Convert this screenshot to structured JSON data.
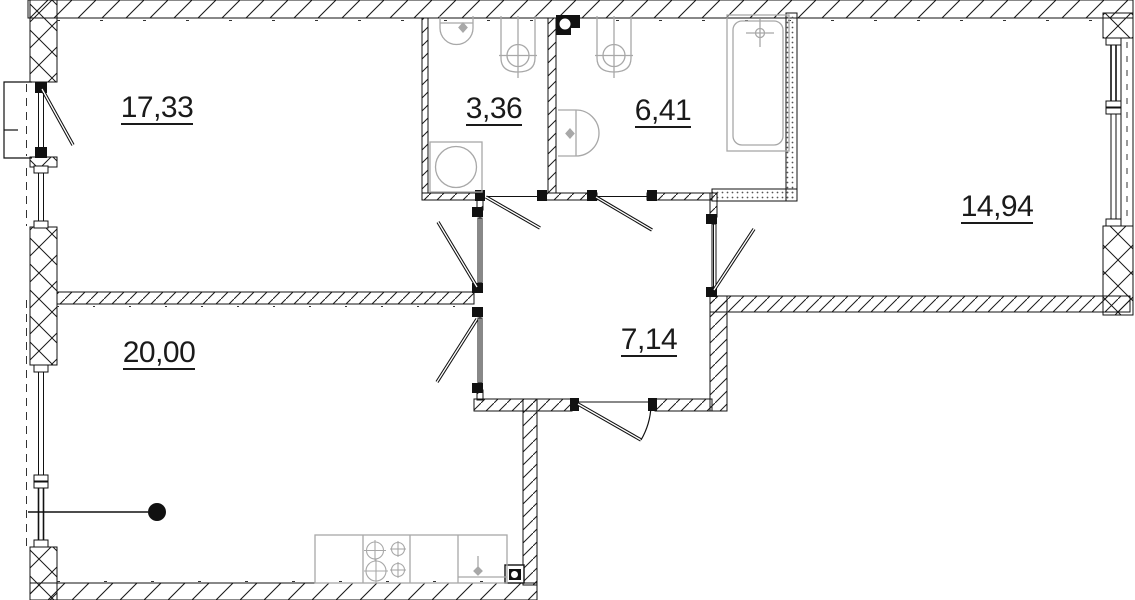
{
  "plan": {
    "background": "#ffffff",
    "line_color": "#1a1a1a",
    "fixture_color": "#a8a8a8",
    "rooms": [
      {
        "id": "room-17-33",
        "area": "17,33"
      },
      {
        "id": "bathroom-small",
        "area": "3,36"
      },
      {
        "id": "bathroom-large",
        "area": "6,41"
      },
      {
        "id": "room-14-94",
        "area": "14,94"
      },
      {
        "id": "hallway",
        "area": "7,14"
      },
      {
        "id": "kitchen-living-room",
        "area": "20,00"
      }
    ],
    "fixture_icons": [
      "corner-sink-icon",
      "toilet-icon",
      "washing-machine-icon",
      "wall-sink-icon",
      "toilet-icon",
      "bathtub-icon",
      "kitchen-counter-icon",
      "stove-4-burner-icon",
      "kitchen-sink-icon",
      "ventilation-shaft-icon",
      "ventilation-shaft-icon",
      "balcony-icon",
      "section-dot-marker-icon"
    ]
  }
}
